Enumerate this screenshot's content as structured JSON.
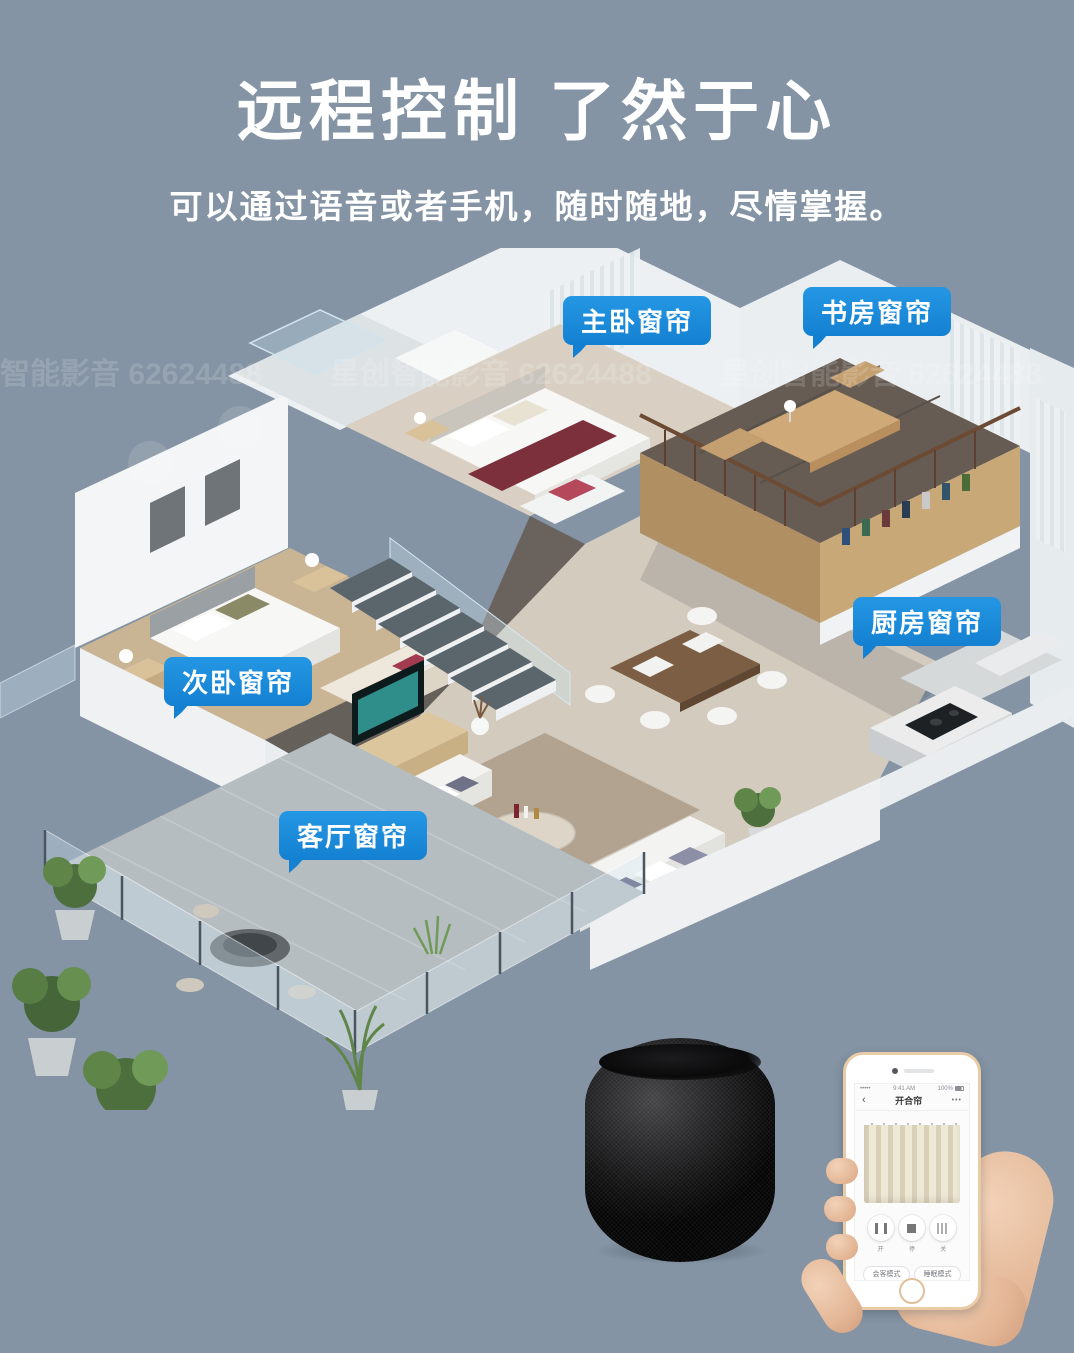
{
  "colors": {
    "background": "#8494a4",
    "bubble_blue": "#1480d1",
    "accent_white": "#ffffff"
  },
  "header": {
    "title": "远程控制 了然于心",
    "subtitle": "可以通过语音或者手机，随时随地，尽情掌握。"
  },
  "watermark": {
    "text": "星创智能影音 62624488"
  },
  "callouts": {
    "master": "主卧窗帘",
    "study": "书房窗帘",
    "kitchen": "厨房窗帘",
    "second": "次卧窗帘",
    "living": "客厅窗帘"
  },
  "phone": {
    "carrier": "•••••",
    "time": "9:41 AM",
    "battery": "100%",
    "back": "‹",
    "title": "开合帘",
    "menu": "•••",
    "controls": {
      "open": "开",
      "pause": "停",
      "close": "关"
    },
    "modes": {
      "m1": "会客模式",
      "m2": "睡眠模式",
      "m3": "起床模式",
      "m4": "透光模式"
    }
  }
}
